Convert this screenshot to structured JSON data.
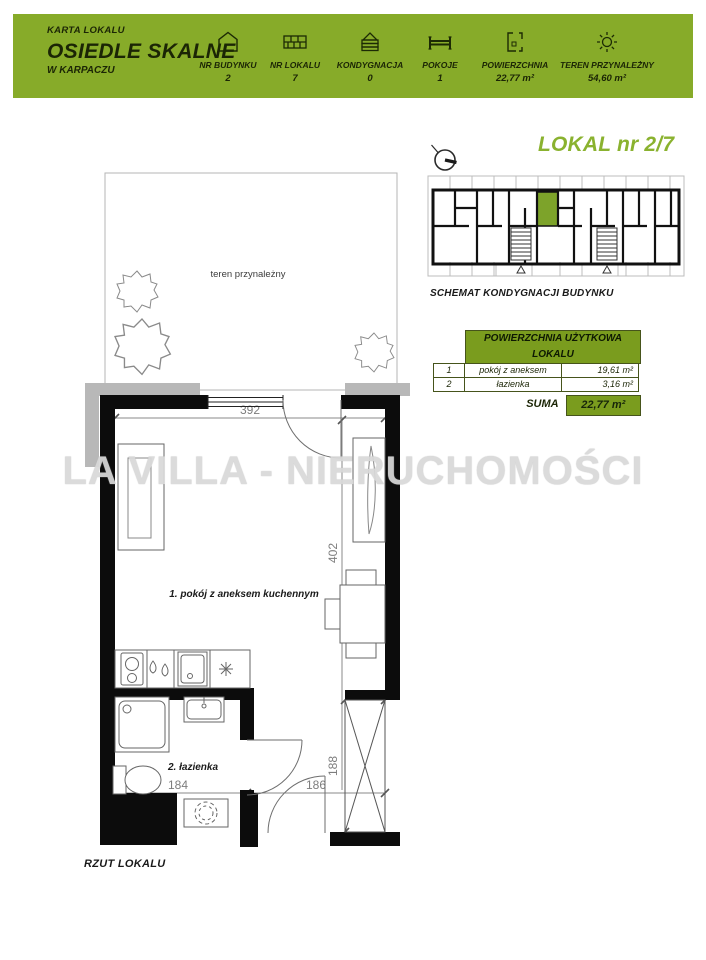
{
  "header": {
    "card_label": "KARTA LOKALU",
    "estate_name": "OSIEDLE SKALNE",
    "estate_location": "W KARPACZU",
    "stats": [
      {
        "icon": "building-icon",
        "label": "NR BUDYNKU",
        "value": "2"
      },
      {
        "icon": "unit-grid-icon",
        "label": "NR LOKALU",
        "value": "7"
      },
      {
        "icon": "storey-icon",
        "label": "KONDYGNACJA",
        "value": "0"
      },
      {
        "icon": "bed-icon",
        "label": "POKOJE",
        "value": "1"
      },
      {
        "icon": "floor-plan-icon",
        "label": "POWIERZCHNIA",
        "value": "22,77 m²"
      },
      {
        "icon": "sun-icon",
        "label": "TEREN PRZYNALEŻNY",
        "value": "54,60 m²"
      }
    ]
  },
  "unit": {
    "title": "LOKAL nr 2/7",
    "schematic_caption": "SCHEMAT KONDYGNACJI BUDYNKU"
  },
  "area_table": {
    "header": "POWIERZCHNIA UŻYTKOWA LOKALU",
    "rows": [
      {
        "no": "1",
        "name": "pokój z aneksem",
        "area": "19,61 m²"
      },
      {
        "no": "2",
        "name": "łazienka",
        "area": "3,16 m²"
      }
    ],
    "sum_label": "SUMA",
    "sum_value": "22,77 m²"
  },
  "floor_plan": {
    "garden_label": "teren przynależny",
    "room1_label": "1. pokój z aneksem kuchennym",
    "room2_label": "2. łazienka",
    "dimensions": {
      "top_width": "392",
      "right_height": "402",
      "bath_width": "184",
      "hall_width": "186",
      "storage_height": "188"
    },
    "caption": "RZUT LOKALU"
  },
  "watermark": "LA VILLA - NIERUCHOMOŚCI",
  "colors": {
    "header_green": "#87ab29",
    "table_green": "#7a9c1e",
    "title_green": "#8ab22f",
    "schematic_highlight": "#7da32a",
    "watermark_gray": "#d9d9d9"
  }
}
